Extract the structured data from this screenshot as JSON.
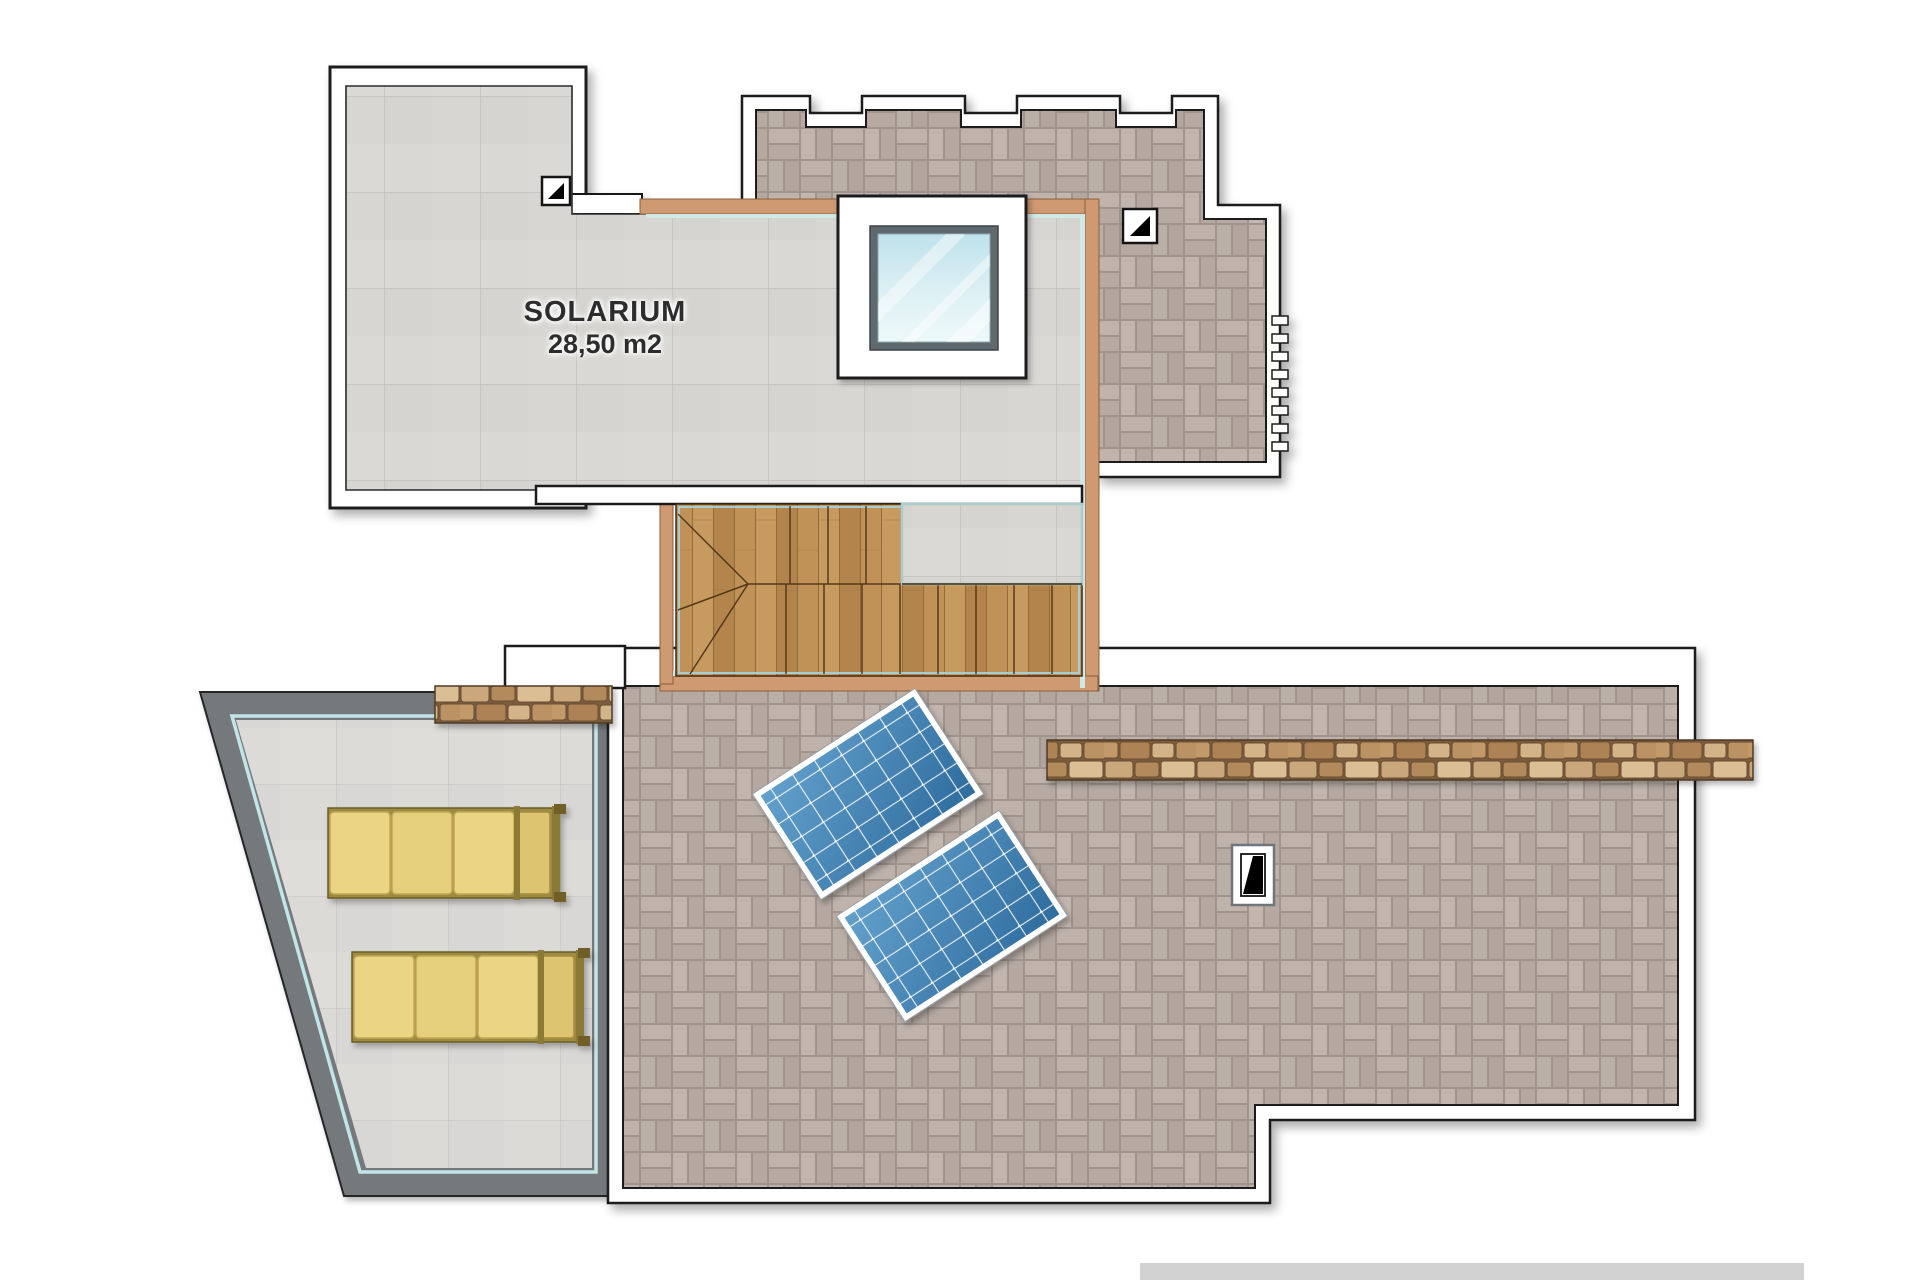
{
  "plan": {
    "room": {
      "name": "SOLARIUM",
      "area": "28,50 m2"
    },
    "features": [
      "solarium-deck",
      "skylight-window",
      "wooden-staircase",
      "solar-panel-pair",
      "sun-lounger-pair",
      "stone-wall-strips",
      "tiled-roof-terrace",
      "crenellated-parapet"
    ],
    "palette": {
      "outline": "#1b1b1b",
      "mauve_tile": "#b7aba4",
      "gray_tile": "#d7d5d2",
      "wood": "#bf9459",
      "tan_wall": "#cf9a72",
      "teal_glass": "#bfe4e6",
      "stone": "#c9a87b",
      "dark_wall": "#75797c",
      "lounger_cushion": "#e9d584",
      "lounger_frame": "#8a7a35",
      "panel_blue": "#3f7fae",
      "glass_blue": "#cfe9f2"
    }
  }
}
